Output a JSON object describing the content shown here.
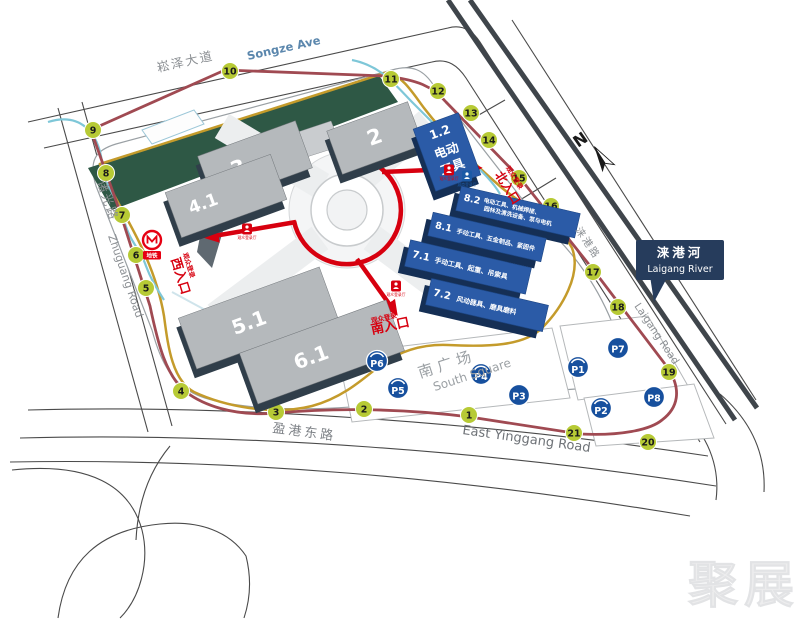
{
  "watermark": "聚展",
  "compass": {
    "label": "N"
  },
  "roads": {
    "songze": {
      "zh": "崧泽大道",
      "en": "Songze Ave"
    },
    "zhuguang": {
      "zh": "诸光路",
      "en": "Zhuguang Road"
    },
    "yinggang": {
      "zh": "盈港东路",
      "en": "East Yinggang Road"
    },
    "laigang": {
      "zh": "涞港路",
      "en": "Laigang Road"
    }
  },
  "river": {
    "zh": "涞港河",
    "en": "Laigang River"
  },
  "metro": {
    "label": "地铁"
  },
  "south_square": {
    "zh": "南广场",
    "en": "South Square"
  },
  "entrances": {
    "west": {
      "note": "观众登录",
      "name": "西入口"
    },
    "south": {
      "note": "观众登录",
      "name": "南入口"
    },
    "north": {
      "note": "观众登录",
      "name": "北入口"
    }
  },
  "registration_badges": {
    "visitor": "观众登录厅",
    "exhibitor": "展商登录厅"
  },
  "halls": {
    "gray": [
      {
        "id": "2",
        "label": "2"
      },
      {
        "id": "3",
        "label": "3"
      },
      {
        "id": "4.1",
        "label": "4.1"
      },
      {
        "id": "5.1",
        "label": "5.1"
      },
      {
        "id": "6.1",
        "label": "6.1"
      }
    ],
    "blue": [
      {
        "id": "1.2",
        "label": "1.2",
        "line1": "电动",
        "line2": "工具"
      },
      {
        "id": "8.2",
        "label": "8.2",
        "desc1": "电动工具、机械焊接、",
        "desc2": "园林及清洗设备、泵与电机"
      },
      {
        "id": "8.1",
        "label": "8.1",
        "desc1": "手动工具、五金制品、紧固件",
        "desc2": ""
      },
      {
        "id": "7.1",
        "label": "7.1",
        "desc1": "手动工具、起重、吊索具",
        "desc2": ""
      },
      {
        "id": "7.2",
        "label": "7.2",
        "desc1": "风动器具、磨具磨料",
        "desc2": ""
      }
    ]
  },
  "stops": [
    "1",
    "2",
    "3",
    "4",
    "5",
    "6",
    "7",
    "8",
    "9",
    "10",
    "11",
    "12",
    "13",
    "14",
    "15",
    "16",
    "17",
    "18",
    "19",
    "20",
    "21"
  ],
  "parking": [
    {
      "id": "P1",
      "arc": true
    },
    {
      "id": "P2",
      "arc": true
    },
    {
      "id": "P3",
      "arc": false
    },
    {
      "id": "P4",
      "arc": true
    },
    {
      "id": "P5",
      "arc": true
    },
    {
      "id": "P6",
      "arc": true
    },
    {
      "id": "P7",
      "arc": false
    },
    {
      "id": "P8",
      "arc": false
    }
  ],
  "colors": {
    "stop_green": "#b7ca35",
    "parking_blue": "#17509e",
    "hall_blue": "#2b5ba7",
    "hall_blue_side": "#152f55",
    "hall_gray": "#b5b9bc",
    "hall_gray_side": "#303e4a",
    "route_red": "#d7000f",
    "route_maroon": "#a04a52",
    "route_gold": "#c49b2b",
    "route_teal": "#7ec7d8",
    "river_sign_navy": "#263c5c",
    "green_strip": "#2e5845"
  }
}
